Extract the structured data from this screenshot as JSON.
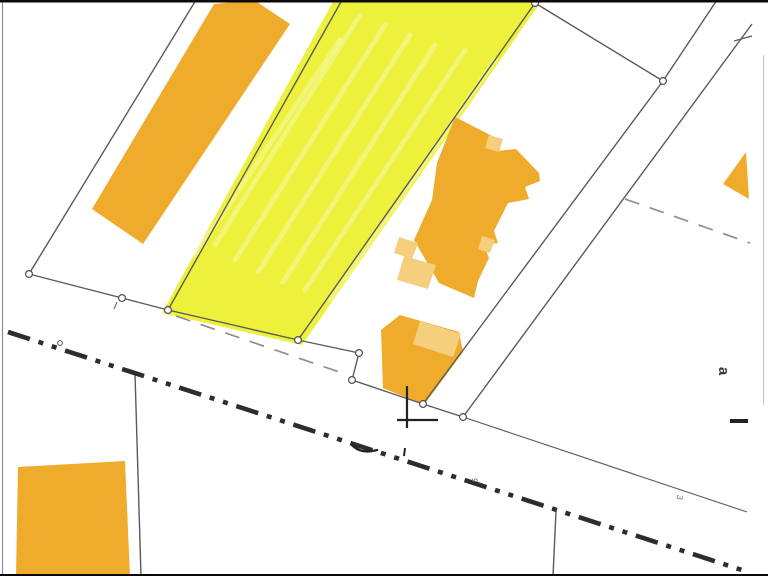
{
  "page": {
    "width": 768,
    "height": 576,
    "background": "#ffffff"
  },
  "map": {
    "colors": {
      "building_orange": "#EFAC2C",
      "roof_light_orange": "#F6CF7E",
      "highlight_yellow": "#EDF13C",
      "paint_streak": "rgba(255,255,255,0.30)",
      "boundary_line": "#5a5a5a",
      "front_line": "#6a6a6a",
      "dashed_line": "#8d8d8d",
      "road_dashdot": "#2d2d2d",
      "mark_dark": "#222222",
      "vertex_stroke": "#4f4f4f",
      "vertex_fill": "#ffffff",
      "border_left": "#8f8f8f",
      "border_right": "#c4c4c4",
      "letterbox": "#0a0a0a"
    },
    "letterbox": {
      "top": [
        0,
        0,
        768,
        2.5
      ],
      "bottom": [
        0,
        574,
        768,
        2
      ]
    },
    "highlight_parcel": {
      "name": "parcel-highlight-yellow",
      "points": "334,0 542,0 302,345 162,313"
    },
    "paint_streaks": [
      [
        360,
        15,
        215,
        245
      ],
      [
        385,
        25,
        235,
        260
      ],
      [
        410,
        35,
        258,
        272
      ],
      [
        435,
        45,
        283,
        282
      ],
      [
        465,
        50,
        305,
        290
      ],
      [
        495,
        60,
        330,
        300
      ],
      [
        340,
        40,
        195,
        255
      ]
    ],
    "buildings": [
      {
        "name": "building-strip-northwest",
        "points": "214,4 254,0 290,24 143,244 92,209"
      },
      {
        "name": "building-block-southwest",
        "points": "18,467 125,461 130,576 16,576"
      },
      {
        "name": "building-cluster-center",
        "points": "455,117 500,140 497,151 516,149 539,173 540,181 525,187 529,199 508,203 494,231 498,243 484,245 489,258 478,281 474,298 439,283 414,240 432,200 437,163 446,140"
      },
      {
        "name": "building-lower-center",
        "points": "400,315 459,332 463,352 424,405 383,388 381,330"
      },
      {
        "name": "building-corner-northeast",
        "points": "746,152 749,199 723,184"
      }
    ],
    "roof_patches": [
      {
        "name": "roof-patch-cluster-top",
        "points": "489,135 503,139 499,152 485,148"
      },
      {
        "name": "roof-patch-cluster-left-mid",
        "points": "399,237 418,243 412,259 394,253"
      },
      {
        "name": "roof-patch-cluster-left-low",
        "points": "404,256 436,265 428,289 397,280"
      },
      {
        "name": "roof-patch-cluster-right",
        "points": "482,236 495,240 490,253 478,249"
      },
      {
        "name": "roof-patch-lower-building",
        "points": "420,321 461,334 453,357 413,344"
      }
    ],
    "boundary_lines": [
      {
        "name": "parcel-line-west",
        "c": [
          196,
          0,
          29,
          274
        ]
      },
      {
        "name": "street-front-line-w1",
        "c": [
          29,
          274,
          122,
          298
        ]
      },
      {
        "name": "street-front-line-w2",
        "c": [
          122,
          298,
          168,
          310
        ]
      },
      {
        "name": "yellow-parcel-south-edge",
        "c": [
          168,
          310,
          298,
          340
        ]
      },
      {
        "name": "yellow-parcel-west-edge",
        "c": [
          342,
          0,
          168,
          310
        ]
      },
      {
        "name": "yellow-parcel-east-edge",
        "c": [
          535,
          3,
          298,
          340
        ]
      },
      {
        "name": "front-chain-1",
        "c": [
          298,
          340,
          359,
          353
        ]
      },
      {
        "name": "front-chain-2",
        "c": [
          359,
          353,
          352,
          380
        ]
      },
      {
        "name": "front-chain-3",
        "c": [
          352,
          380,
          423,
          404
        ]
      },
      {
        "name": "front-chain-4",
        "c": [
          423,
          404,
          463,
          417
        ]
      },
      {
        "name": "street-front-line-east",
        "c": [
          463,
          417,
          747,
          512
        ],
        "w": 1.1
      },
      {
        "name": "parcel-line-center-east",
        "c": [
          663,
          81,
          423,
          404
        ]
      },
      {
        "name": "parcel-line-east",
        "c": [
          752,
          24,
          463,
          417
        ]
      },
      {
        "name": "parcel-line-ne-upper",
        "c": [
          663,
          81,
          717,
          0
        ]
      },
      {
        "name": "parcel-line-ne-to-yellow",
        "c": [
          663,
          81,
          535,
          3
        ]
      },
      {
        "name": "tick-northeast",
        "c": [
          734,
          41,
          752,
          36
        ],
        "w": 1.2
      },
      {
        "name": "parcel-line-south-left",
        "c": [
          135,
          374,
          141,
          576
        ]
      },
      {
        "name": "parcel-line-south-center",
        "c": [
          556,
          511,
          553,
          576
        ]
      },
      {
        "name": "tick-west",
        "c": [
          117,
          302,
          114,
          309
        ],
        "w": 1
      }
    ],
    "dashed_lines": [
      {
        "name": "hidden-boundary-dashed-northeast",
        "c": [
          625,
          199,
          750,
          243
        ]
      },
      {
        "name": "hidden-boundary-dashed-center",
        "c": [
          176,
          316,
          348,
          375
        ]
      }
    ],
    "road_line": {
      "name": "road-boundary-dashdot",
      "c": [
        8,
        332,
        748,
        572
      ],
      "w": 4.6,
      "dash": "23 9 5 9 5 9"
    },
    "survey_marks": {
      "cross": [
        [
          407,
          386,
          407,
          428
        ],
        [
          397,
          420,
          438,
          420
        ]
      ],
      "iso_dash": [
        730,
        421,
        748,
        421
      ],
      "hook_path": "M352,445 C358,451 365,453 377,450",
      "tick_small": [
        405,
        448,
        404,
        456
      ]
    },
    "vertex_markers": [
      [
        535,
        3
      ],
      [
        663,
        81
      ],
      [
        29,
        274
      ],
      [
        122,
        298
      ],
      [
        168,
        310
      ],
      [
        298,
        340
      ],
      [
        359,
        353
      ],
      [
        352,
        380
      ],
      [
        423,
        404
      ],
      [
        463,
        417
      ]
    ],
    "small_ring": [
      60,
      343
    ],
    "labels": [
      {
        "name": "label-a",
        "text": "a",
        "x": 719,
        "y": 371,
        "rotate": 90,
        "size": 15,
        "color": "#333333",
        "weight": "700"
      },
      {
        "name": "label-3",
        "text": "3",
        "x": 677,
        "y": 497,
        "rotate": 97,
        "size": 9,
        "color": "#777777",
        "weight": "400"
      },
      {
        "name": "label-9",
        "text": "9",
        "x": 472,
        "y": 480,
        "rotate": 97,
        "size": 8,
        "color": "#555555",
        "weight": "400"
      }
    ],
    "borders": {
      "left": [
        2.5,
        2,
        2.5,
        576
      ],
      "right": [
        763.5,
        55,
        763.5,
        405
      ]
    }
  }
}
